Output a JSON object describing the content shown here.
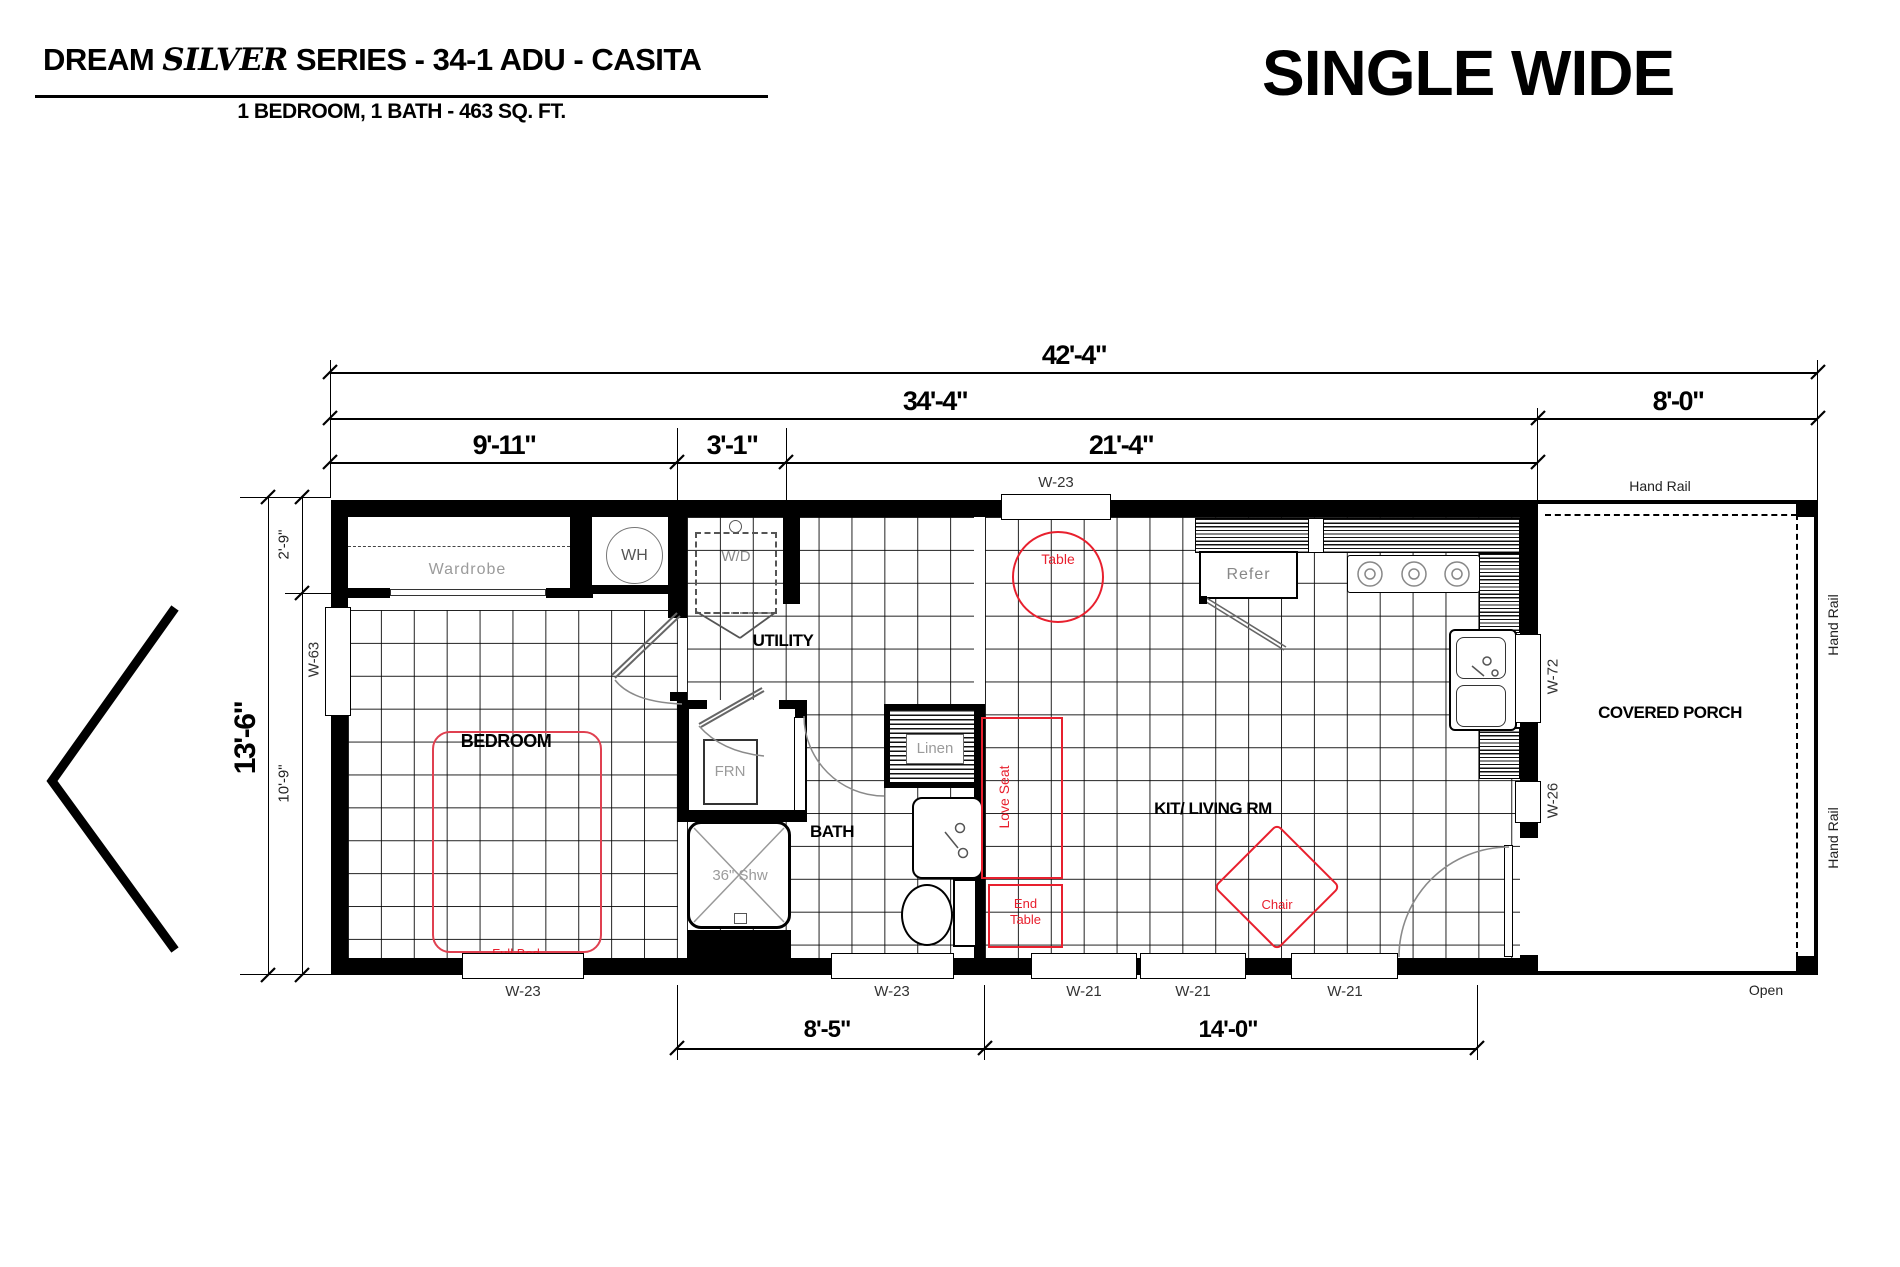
{
  "header": {
    "title_part1": "DREAM ",
    "title_italic": "SILVER",
    "title_part2": " SERIES  - 34-1 ADU  -  CASITA",
    "subtitle": "1 BEDROOM, 1 BATH - 463 SQ. FT.",
    "type_label": "SINGLE WIDE"
  },
  "dimensions": {
    "overall_width": "42'-4\"",
    "main_width": "34'-4\"",
    "porch_width": "8'-0\"",
    "bedroom_width": "9'-11\"",
    "utility_width": "3'-1\"",
    "living_width": "21'-4\"",
    "overall_depth": "13'-6\"",
    "closet_depth": "2'-9\"",
    "bedroom_depth": "10'-9\"",
    "bath_width": "8'-5\"",
    "living_bottom_width": "14'-0\""
  },
  "windows": {
    "top_kitchen": "W-23",
    "left_bedroom": "W-63",
    "right_kitchen": "W-72",
    "right_living": "W-26",
    "bottom_bedroom": "W-23",
    "bottom_bath": "W-23",
    "bottom_living_1": "W-21",
    "bottom_living_2": "W-21",
    "bottom_living_3": "W-21"
  },
  "rooms": {
    "bedroom": "BEDROOM",
    "utility": "UTILITY",
    "bath": "BATH",
    "kit_living": "KIT/ LIVING RM",
    "covered_porch": "COVERED PORCH"
  },
  "fixtures": {
    "wardrobe": "Wardrobe",
    "water_heater": "WH",
    "washer_dryer": "W/D",
    "furnace": "FRN",
    "shower": "36\" Shw",
    "linen": "Linen",
    "refrigerator": "Refer",
    "full_bed": "Full Bed",
    "table": "Table",
    "love_seat": "Love Seat",
    "end_table_line1": "End",
    "end_table_line2": "Table",
    "chair": "Chair"
  },
  "porch": {
    "hand_rail_top": "Hand Rail",
    "hand_rail_right_upper": "Hand Rail",
    "hand_rail_right_lower": "Hand Rail",
    "open_label": "Open"
  },
  "colors": {
    "wall_black": "#000000",
    "furniture_red": "#e8202e",
    "appliance_grey": "#9b9b9b"
  }
}
